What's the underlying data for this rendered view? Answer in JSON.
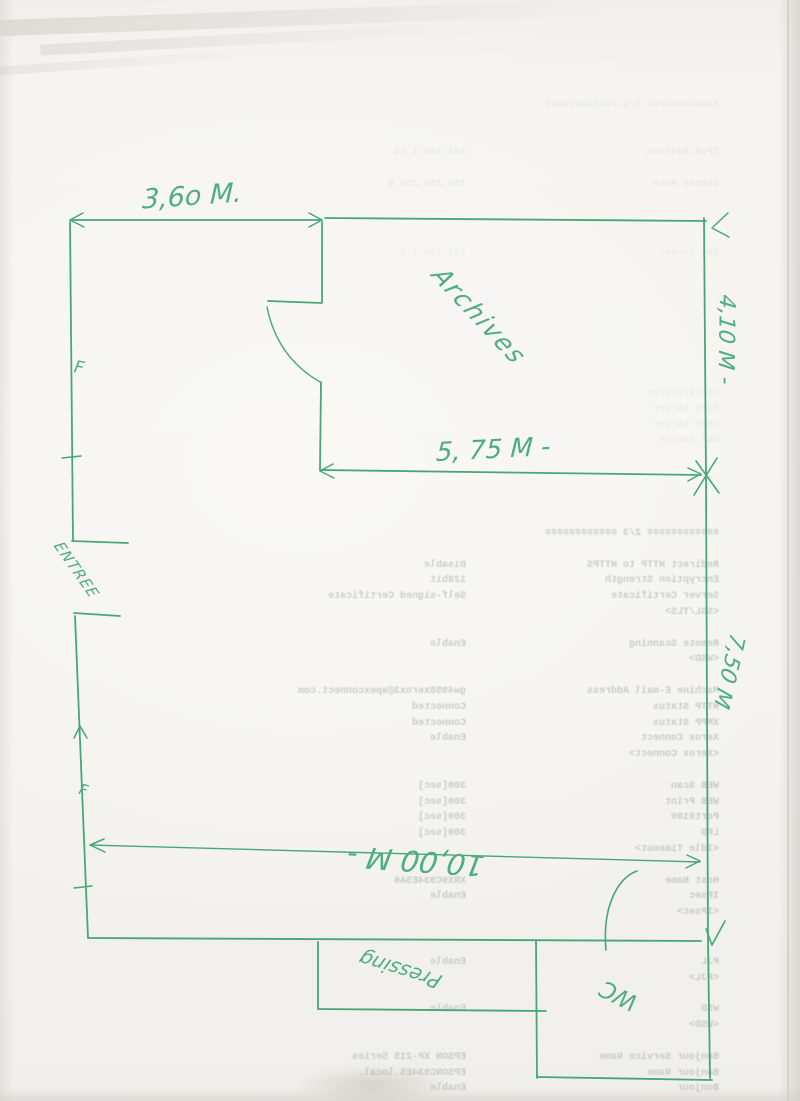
{
  "palette": {
    "paper": "#f4f3f0",
    "pen_green": "#46a877",
    "handwriting_green": "#4fae81",
    "ghost_print_gray": "#8fa09a"
  },
  "plan": {
    "room_label": "Archives",
    "entry_label": "ENTREE",
    "shop_label": "Pressing",
    "wc_label": "WC",
    "window_marker_top": "F",
    "window_marker_bottom": "F",
    "dimensions": {
      "top_width": "3,6o M.",
      "archives_width": "5, 75 M -",
      "archives_height": "4,10 M -",
      "right_lower_height": "7,50 M",
      "total_width": "10,00 M -"
    }
  },
  "ghost_print": {
    "note": "faint mirrored bleed-through of a printer configuration report",
    "sections": {
      "top_faint": {
        "rows": [
          [
            "############ 1/3 ############",
            ""
          ],
          [
            "",
            ""
          ],
          [
            "",
            ""
          ],
          [
            "IPv4 Address",
            "192.168.1.15"
          ],
          [
            "",
            ""
          ],
          [
            "Subnet Mask",
            "255.255.255.0"
          ]
        ]
      },
      "mid_faint1": {
        "rows": [
          [
            "DNS Server",
            "192.168.1.1"
          ]
        ]
      },
      "mid_faint2": {
        "rows": [
          [
            "Certificates",
            ""
          ],
          [
            "POP3 Server",
            ""
          ],
          [
            "SMTP Server",
            ""
          ],
          [
            "DNS Server",
            ""
          ]
        ]
      },
      "config": {
        "rows": [
          [
            "############ 2/3 ############",
            ""
          ],
          [
            "",
            ""
          ],
          [
            "Redirect HTTP to HTTPS",
            "Disable"
          ],
          [
            "Encryption Strength",
            "128bit"
          ],
          [
            "Server Certificate",
            "Self-signed Certificate"
          ],
          [
            "<SSL/TLS>",
            ""
          ],
          [
            "",
            ""
          ],
          [
            "Remote Scanning",
            "Enable"
          ],
          [
            "<WSD>",
            ""
          ],
          [
            "",
            ""
          ],
          [
            "Machine E-mail Address",
            "gw4958xerox3@apexconnect.com"
          ],
          [
            "HTTP Status",
            "Connected"
          ],
          [
            "XMPP Status",
            "Connected"
          ],
          [
            "Xerox Connect",
            "Enable"
          ],
          [
            "<Xerox Connect>",
            ""
          ],
          [
            "",
            ""
          ],
          [
            "WEB Scan",
            "300[sec]"
          ],
          [
            "WEB Print",
            "300[sec]"
          ],
          [
            "Port9100",
            "300[sec]"
          ],
          [
            "LPD",
            "300[sec]"
          ],
          [
            "<Idle Timeout>",
            ""
          ],
          [
            "",
            ""
          ],
          [
            "Host Name",
            "XRX9C934E5A6"
          ],
          [
            "IPsec",
            "Enable"
          ],
          [
            "<IPsec>",
            ""
          ]
        ]
      },
      "bottom": {
        "rows": [
          [
            "PJL",
            "Enable"
          ],
          [
            "<PJL>",
            ""
          ],
          [
            "",
            ""
          ],
          [
            "WSD",
            "Enable"
          ],
          [
            "<WSD>",
            ""
          ],
          [
            "",
            ""
          ],
          [
            "Bonjour Service Name",
            "EPSON XP-215 Series"
          ],
          [
            "Bonjour Name",
            "EPSONC934E5.local."
          ],
          [
            "Bonjour",
            "Enable"
          ]
        ]
      }
    }
  }
}
